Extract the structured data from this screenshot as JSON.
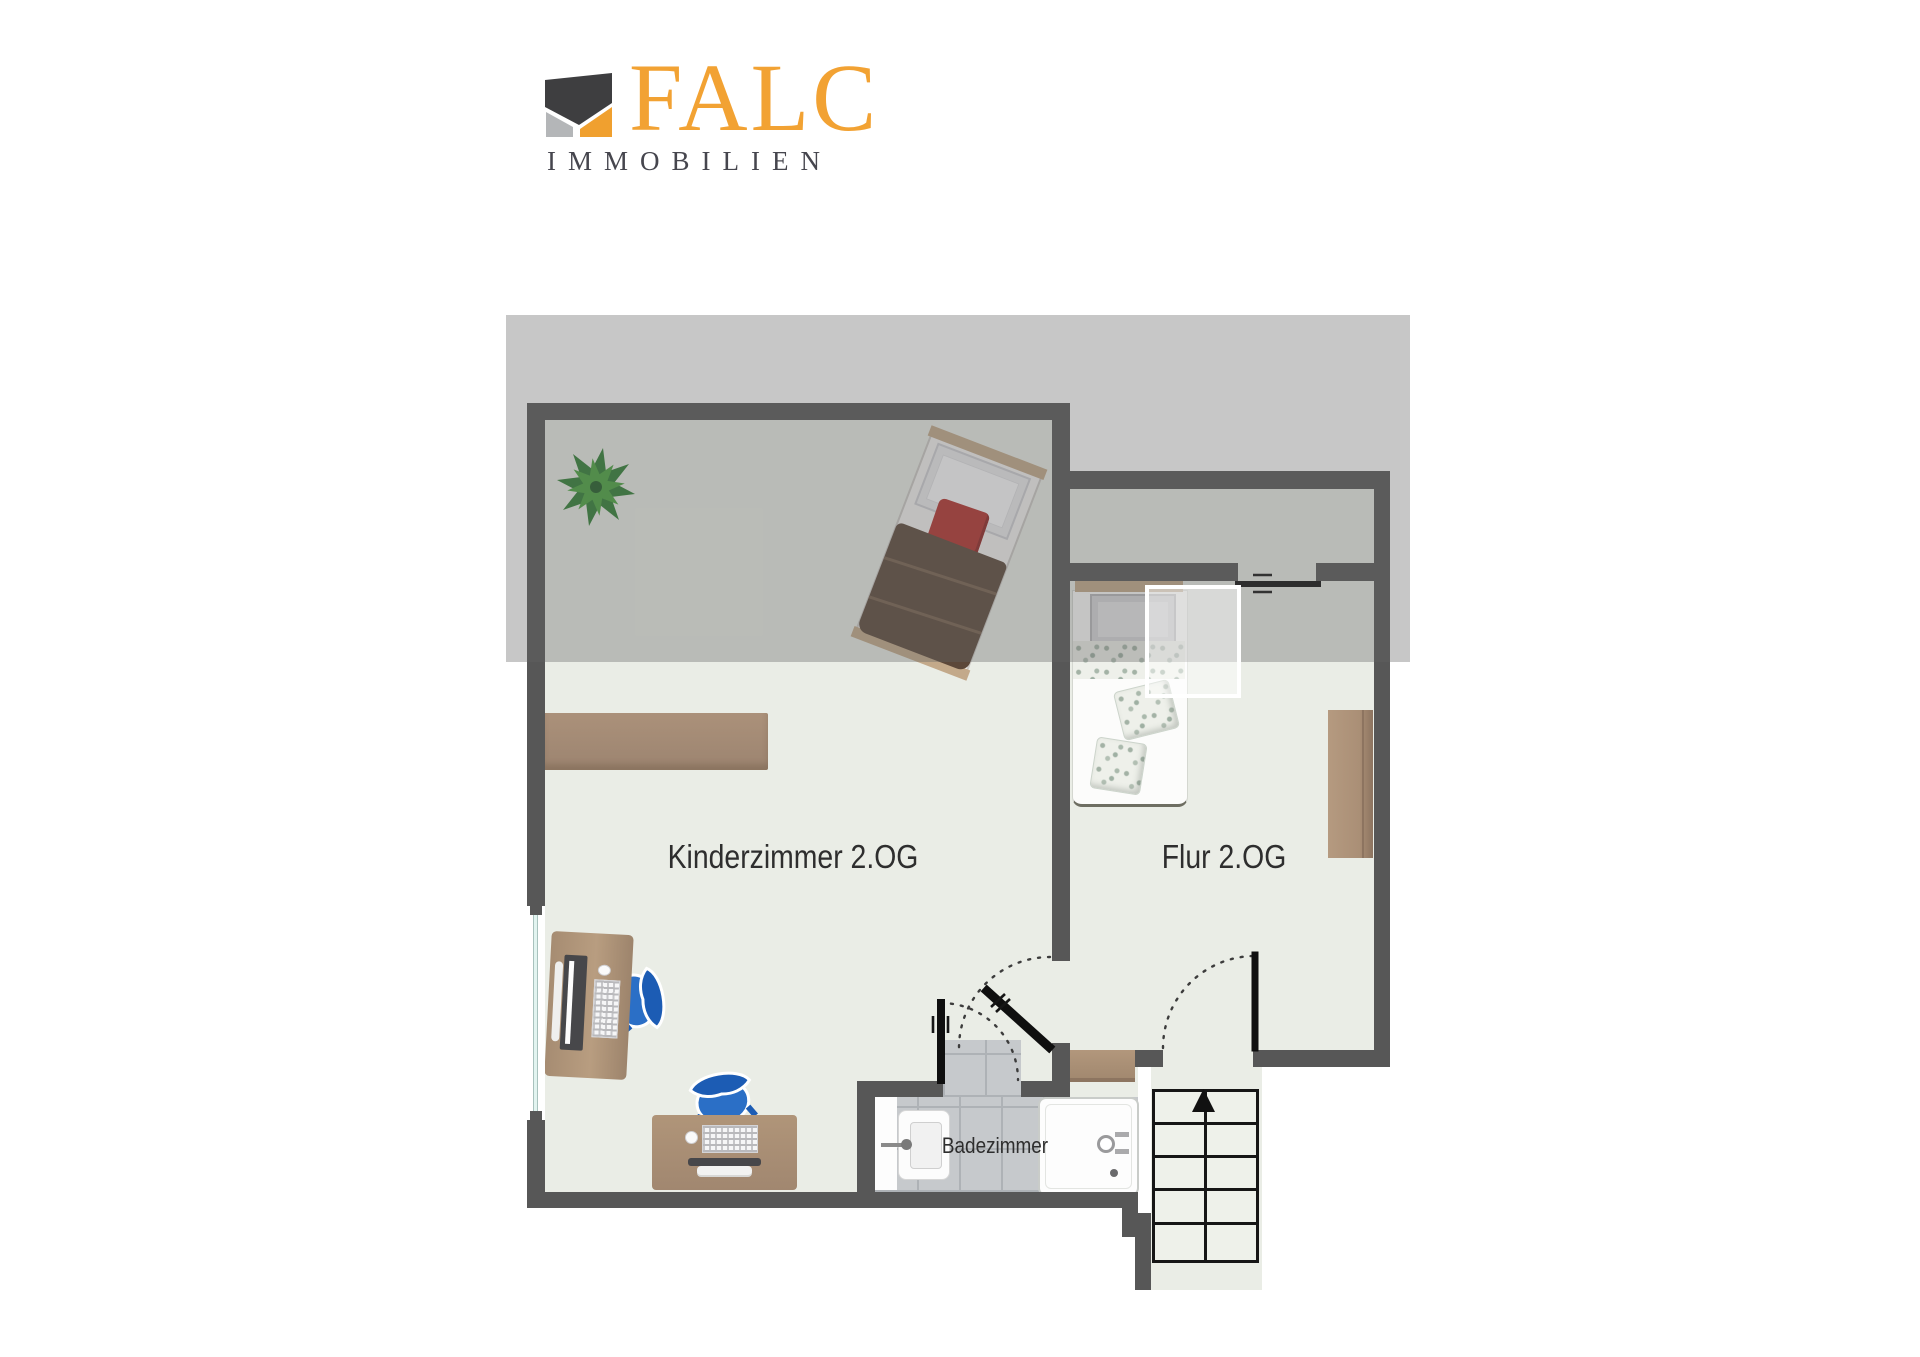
{
  "logo": {
    "brand": "FALC",
    "subtitle": "IMMOBILIEN",
    "brand_color": "#F2A233",
    "subtitle_color": "#46464E",
    "mark_colors": {
      "dark": "#3E3E40",
      "gray": "#B4B6B8",
      "orange": "#F0A02F"
    }
  },
  "floorplan": {
    "rooms": [
      {
        "id": "kinderzimmer",
        "label": "Kinderzimmer 2.OG"
      },
      {
        "id": "flur",
        "label": "Flur 2.OG"
      },
      {
        "id": "badezimmer",
        "label": "Badezimmer"
      }
    ],
    "stairs": {
      "rows": 5,
      "columns": 2,
      "direction": "up"
    },
    "furniture": [
      "plant",
      "single-bed-brown",
      "single-bed-floral",
      "wall-shelf",
      "desk-with-monitor",
      "desk-with-monitor-keyboard",
      "office-chair",
      "office-chair",
      "wardrobe",
      "sideboard",
      "shower",
      "sink",
      "staircase"
    ],
    "colors": {
      "wall": "#575757",
      "floor": "#eaede6",
      "tile": "#c6c9cc",
      "wood": "#ab9179",
      "chair_blue": "#2b6fc6",
      "blanket_brown": "#5c483a",
      "pillow_red": "#b3312d",
      "overlay_gray": "rgba(100,100,100,0.36)"
    }
  }
}
